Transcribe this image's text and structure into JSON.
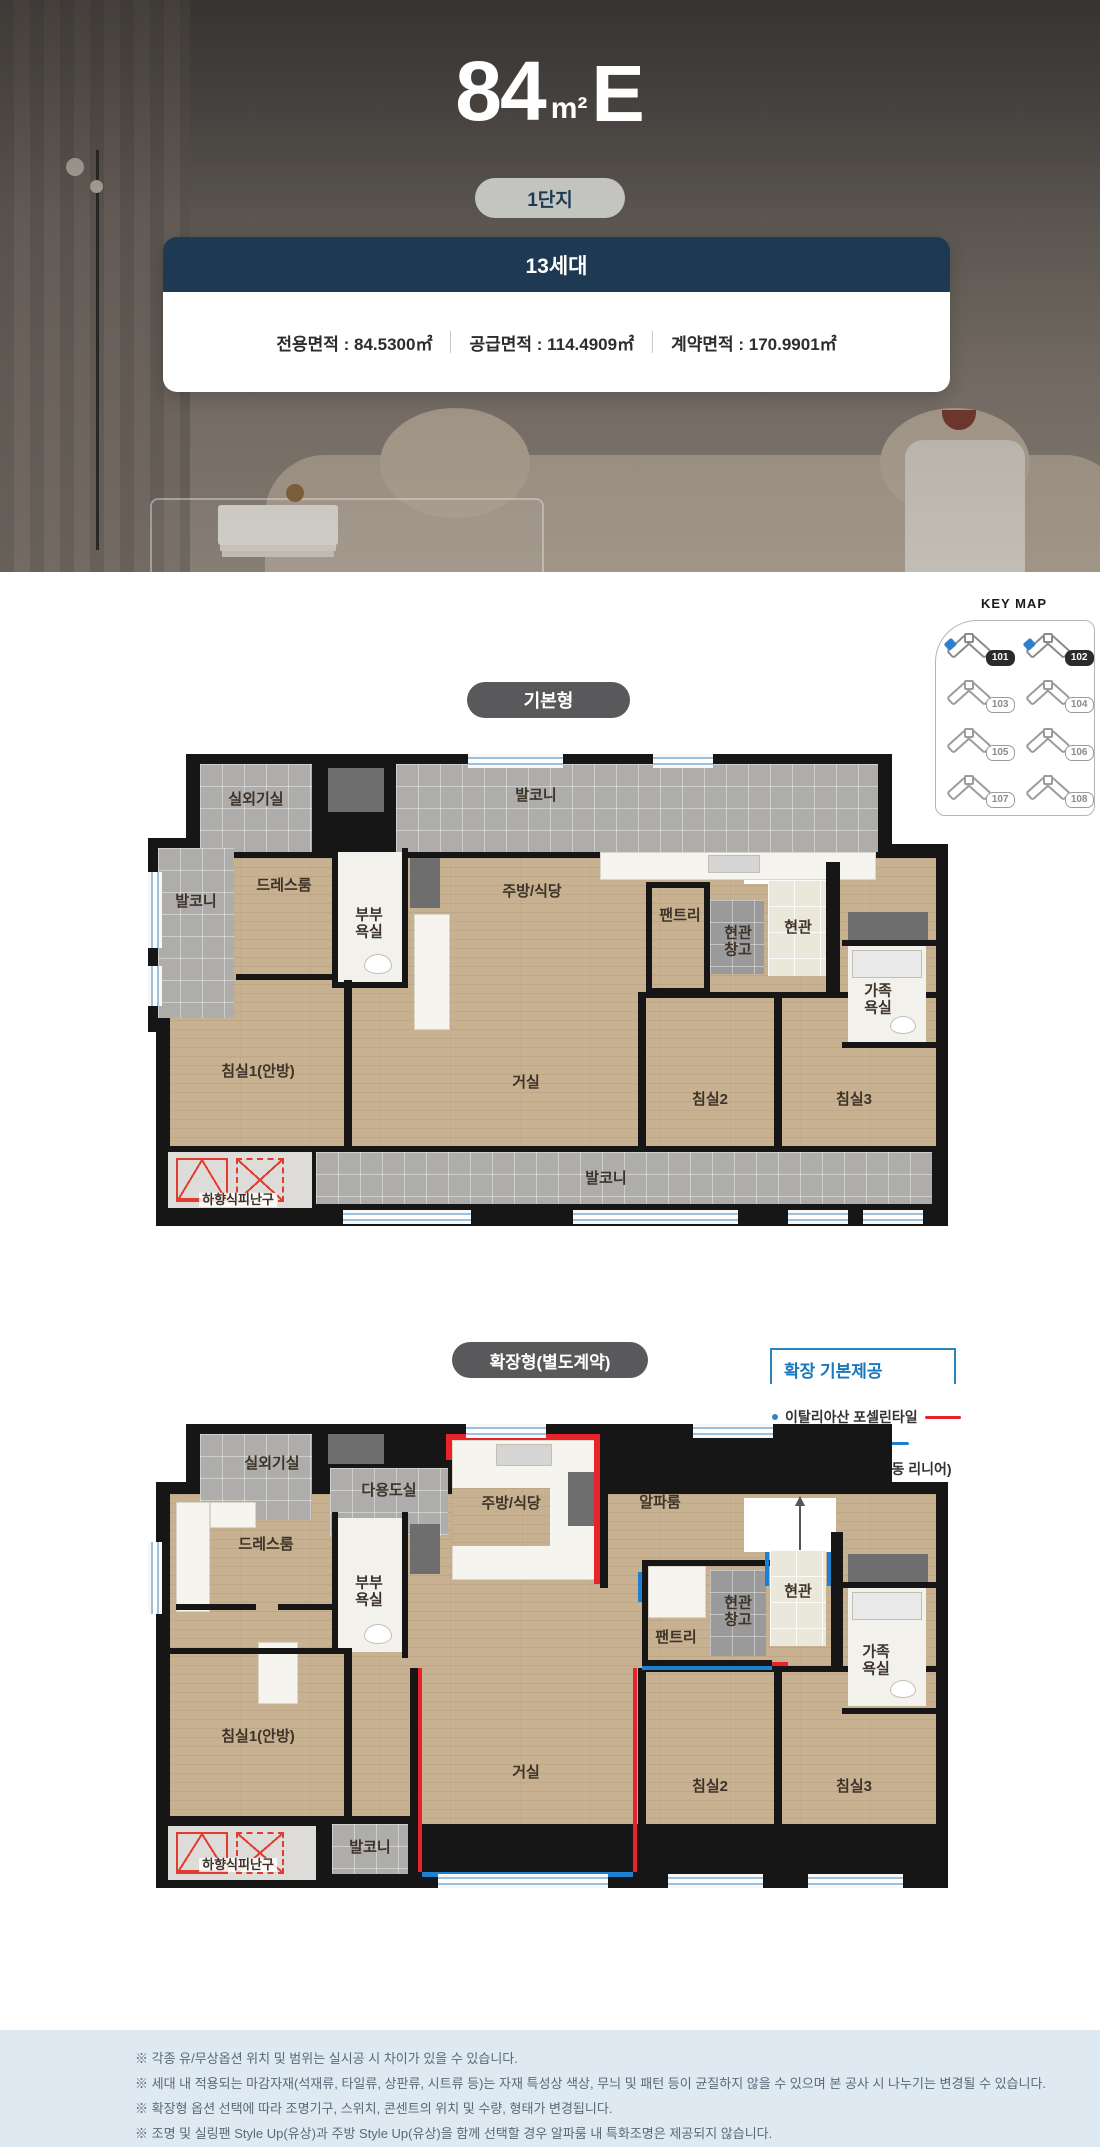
{
  "hero": {
    "unit_number": "84",
    "unit_measure": "m²",
    "unit_letter": "E",
    "complex_badge": "1단지",
    "card": {
      "households": "13세대",
      "areas": [
        "전용면적 : 84.5300㎡",
        "공급면적 : 114.4909㎡",
        "계약면적 : 170.9901㎡"
      ]
    }
  },
  "keymap": {
    "title": "KEY MAP",
    "buildings": [
      {
        "id": "101",
        "active": true
      },
      {
        "id": "102",
        "active": true
      },
      {
        "id": "103",
        "active": false
      },
      {
        "id": "104",
        "active": false
      },
      {
        "id": "105",
        "active": false
      },
      {
        "id": "106",
        "active": false
      },
      {
        "id": "107",
        "active": false
      },
      {
        "id": "108",
        "active": false
      }
    ]
  },
  "plan_basic": {
    "badge": "기본형",
    "rooms": {
      "outdoor": "실외기실",
      "balcony_top": "발코니",
      "balcony_left": "발코니",
      "dress": "드레스룸",
      "couple_bath": "부부\n욕실",
      "kitchen": "주방/식당",
      "pantry": "팬트리",
      "entry_storage": "현관\n창고",
      "entry": "현관",
      "family_bath": "가족\n욕실",
      "bed1": "침실1(안방)",
      "living": "거실",
      "bed2": "침실2",
      "bed3": "침실3",
      "balcony_bottom": "발코니",
      "escape": "하향식피난구"
    }
  },
  "plan_extended": {
    "badge": "확장형(별도계약)",
    "provide": {
      "title": "확장 기본제공",
      "items": [
        {
          "label": "이탈리아산 포셀린타일",
          "line_color": "#e8232a"
        },
        {
          "label": "벽면 시트패널",
          "line_color": "#1f7fd0"
        },
        {
          "label": "현관중문(3연동 자동 리니어)",
          "line_color": ""
        }
      ]
    },
    "rooms": {
      "outdoor": "실외기실",
      "utility": "다용도실",
      "dress": "드레스룸",
      "couple_bath": "부부\n욕실",
      "kitchen": "주방/식당",
      "alpha": "알파룸",
      "pantry": "팬트리",
      "entry_storage": "현관\n창고",
      "entry": "현관",
      "family_bath": "가족\n욕실",
      "bed1": "침실1(안방)",
      "living": "거실",
      "bed2": "침실2",
      "bed3": "침실3",
      "balcony": "발코니",
      "escape": "하향식피난구"
    }
  },
  "colors": {
    "navy": "#1d3a52",
    "accent_red": "#e8232a",
    "accent_blue": "#1f7fd0"
  },
  "footer": {
    "notes": [
      "※ 각종 유/무상옵션 위치 및 범위는 실시공 시 차이가 있을 수 있습니다.",
      "※ 세대 내 적용되는 마감자재(석재류, 타일류, 상판류, 시트류 등)는 자재 특성상 색상, 무늬 및 패턴 등이 균질하지 않을 수 있으며 본 공사 시 나누기는 변경될 수 있습니다.",
      "※ 확장형 옵션 선택에 따라 조명기구, 스위치, 콘센트의 위치 및 수량, 형태가 변경됩니다.",
      "※ 조명 및 실링팬 Style Up(유상)과 주방 Style Up(유상)을 함께 선택할 경우 알파룸 내 특화조명은 제공되지 않습니다."
    ]
  }
}
